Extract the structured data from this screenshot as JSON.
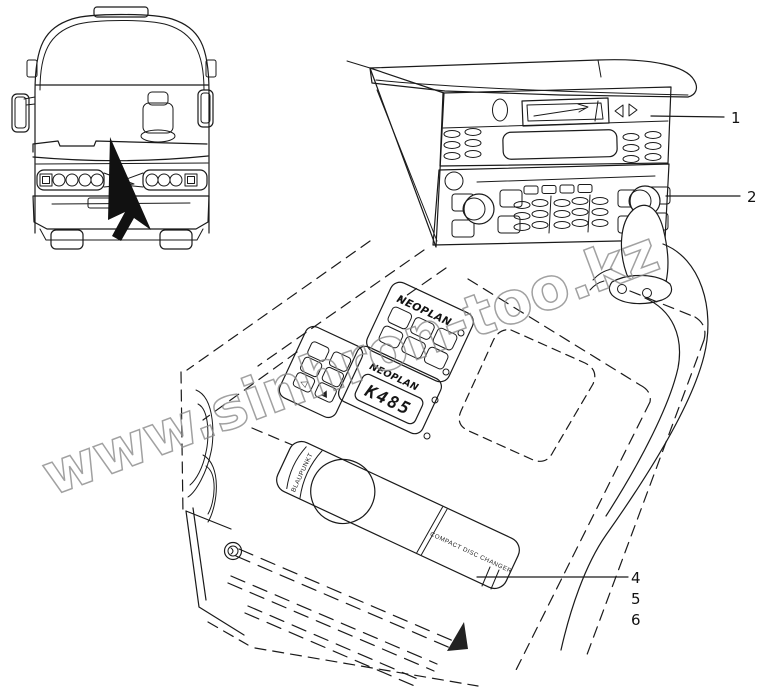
{
  "watermark": {
    "text": "www.sinhron-too.kz"
  },
  "callouts": {
    "c1": "1",
    "c2": "2",
    "c4": "4",
    "c5": "5",
    "c6": "6"
  },
  "labels": {
    "brand_upper": "NEOPLAN",
    "brand_lower": "NEOPLAN",
    "display_code": "K485",
    "cd_brand": "BLAUPUNKT",
    "cd_label": "COMPACT DISC CHANGER",
    "keypad_tri_left": "◁",
    "keypad_tri_up": "▲"
  },
  "colors": {
    "line": "#1a1a1a",
    "background": "#ffffff",
    "watermark_stroke": "#8a8a8a",
    "arrow_fill": "#111111"
  }
}
